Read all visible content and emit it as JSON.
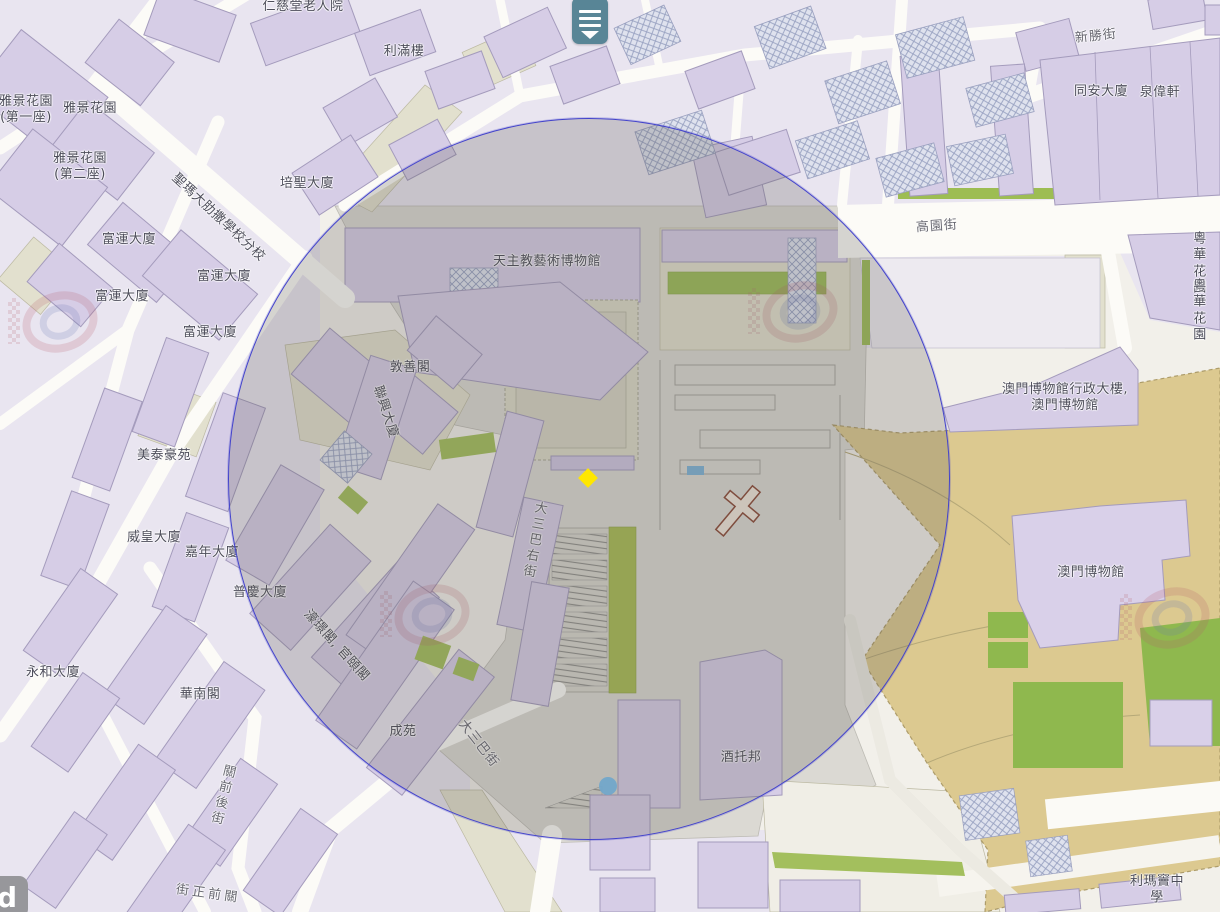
{
  "map": {
    "description": "Web map view of the Ruins of St. Paul's / Monte Fort area, Macau, with a highlighted search-radius circle and a selected-place diamond marker",
    "attribution_partial": "d",
    "colors": {
      "building_fill": "#d6cde6",
      "building_stroke": "#a49bbc",
      "block_fill": "#e9e5f0",
      "road_fill": "#fcfbf7",
      "beige": "#e2e0ce",
      "plaza": "#dbd9d3",
      "green": "#a3bf5d",
      "fortress_tan": "#dcc990",
      "circle_stroke": "#4343cb",
      "circle_fill": "rgba(90,86,84,0.24)",
      "marker_yellow": "#ffe700",
      "dot_blue": "#72a6ca",
      "poi_teal": "#4e7e90",
      "label_color": "#4d4d5a",
      "street_label_color": "#686871"
    },
    "overlay_circle": {
      "cx": 588,
      "cy": 478,
      "r": 360
    },
    "markers": {
      "yellow_diamond": {
        "x": 588,
        "y": 478,
        "color": "#ffe700"
      },
      "blue_dot": {
        "x": 608,
        "y": 786,
        "d": 18,
        "color": "#72a6ca"
      },
      "poi_icon": {
        "x": 590,
        "y": 18,
        "w": 36,
        "h": 42,
        "color": "#4e7e90"
      }
    },
    "labels": {
      "buildings": [
        {
          "text": "雅景花園\n(第一座)",
          "x": 26,
          "y": 110
        },
        {
          "text": "雅景花園",
          "x": 90,
          "y": 109
        },
        {
          "text": "雅景花園\n(第二座)",
          "x": 80,
          "y": 167
        },
        {
          "text": "富運大廈",
          "x": 129,
          "y": 240
        },
        {
          "text": "富運大廈",
          "x": 224,
          "y": 277
        },
        {
          "text": "富運大廈",
          "x": 122,
          "y": 297
        },
        {
          "text": "富運大廈",
          "x": 210,
          "y": 333
        },
        {
          "text": "聖瑪大肋撒學校分校",
          "x": 218,
          "y": 218,
          "rot": 43
        },
        {
          "text": "培聖大廈",
          "x": 307,
          "y": 184
        },
        {
          "text": "仁慈堂老人院",
          "x": 303,
          "y": 7
        },
        {
          "text": "利滿樓",
          "x": 404,
          "y": 52
        },
        {
          "text": "天主教藝術博物館",
          "x": 547,
          "y": 262
        },
        {
          "text": "敦善閣",
          "x": 410,
          "y": 368
        },
        {
          "text": "聯興大廈",
          "x": 385,
          "y": 412,
          "rot": 72
        },
        {
          "text": "美泰豪苑",
          "x": 164,
          "y": 456
        },
        {
          "text": "威皇大廈",
          "x": 154,
          "y": 538
        },
        {
          "text": "嘉年大廈",
          "x": 212,
          "y": 553
        },
        {
          "text": "普慶大廈",
          "x": 260,
          "y": 593
        },
        {
          "text": "濠璟閣, 官頤閣",
          "x": 336,
          "y": 646,
          "rot": 48
        },
        {
          "text": "永和大廈",
          "x": 53,
          "y": 673
        },
        {
          "text": "華南閣",
          "x": 200,
          "y": 695
        },
        {
          "text": "成苑",
          "x": 403,
          "y": 732
        },
        {
          "text": "酒托邦",
          "x": 741,
          "y": 758
        },
        {
          "text": "同安大廈",
          "x": 1101,
          "y": 92
        },
        {
          "text": "泉偉軒",
          "x": 1160,
          "y": 93
        },
        {
          "text": "粵華花園",
          "x": 1200,
          "y": 264
        },
        {
          "text": "粵華花園",
          "x": 1200,
          "y": 311
        },
        {
          "text": "澳門博物館行政大樓,\n澳門博物館",
          "x": 1065,
          "y": 398
        },
        {
          "text": "澳門博物館",
          "x": 1091,
          "y": 573
        },
        {
          "text": "利瑪竇中學",
          "x": 1157,
          "y": 890
        }
      ],
      "streets": [
        {
          "text": "新勝街",
          "x": 1096,
          "y": 37,
          "rot": -6
        },
        {
          "text": "高園街",
          "x": 937,
          "y": 227,
          "rot": -4
        },
        {
          "text": "大三巴右街",
          "x": 533,
          "y": 540,
          "rot": 10,
          "v": true
        },
        {
          "text": "大三巴街",
          "x": 478,
          "y": 744,
          "rot": 52
        },
        {
          "text": "關前後街",
          "x": 221,
          "y": 795,
          "rot": 14,
          "v": true
        },
        {
          "text": "關前正街",
          "x": 204,
          "y": 893,
          "rot": 8,
          "v": true
        }
      ]
    }
  }
}
